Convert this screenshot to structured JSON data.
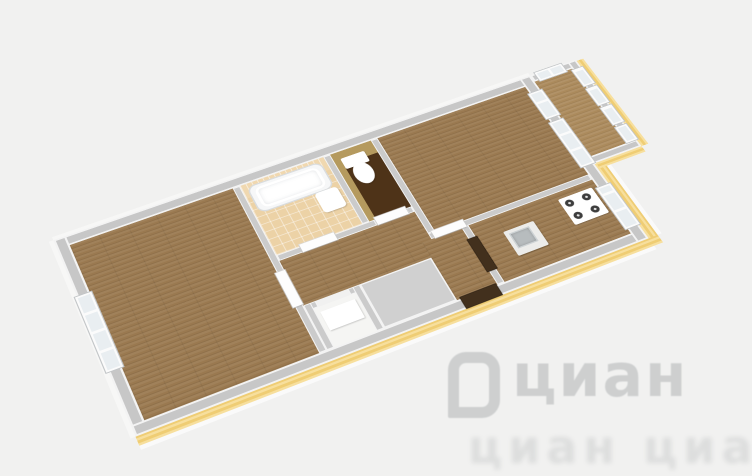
{
  "image": {
    "kind": "3d-apartment-floor-plan"
  },
  "watermark": {
    "brand_text": "циан",
    "tiled_text": "циан циан",
    "logo": "cian-logo"
  },
  "rooms": [
    {
      "name": "bedroom",
      "floor": "wood",
      "features": [
        "window-west"
      ]
    },
    {
      "name": "bathroom",
      "floor": "tile",
      "features": [
        "bathtub",
        "sink",
        "tiled-wall"
      ]
    },
    {
      "name": "wc",
      "floor": "dark-brown",
      "features": [
        "toilet",
        "khaki-walls"
      ]
    },
    {
      "name": "hallway",
      "floor": "wood",
      "features": [
        "entrance-door",
        "storage-niche"
      ]
    },
    {
      "name": "living-room",
      "floor": "wood",
      "features": [
        "balcony-door",
        "window-east"
      ]
    },
    {
      "name": "kitchen",
      "floor": "wood",
      "features": [
        "stove",
        "sink",
        "window-east"
      ]
    },
    {
      "name": "balcony",
      "floor": "wood",
      "features": [
        "glazing-4-panes",
        "window-north"
      ]
    }
  ],
  "colors": {
    "bg": "#f1f1f0",
    "wall-top": "#c7c7c7",
    "wall-edge": "#f3f3f3",
    "wood": "#9a7950",
    "wood-light": "#ab8a5c",
    "tile": "#ecd2a6",
    "tile-wall": "#f0d8b0",
    "khaki": "#b59a5e",
    "toilet-floor": "#4e3318",
    "band": "#efcd74",
    "band-light": "#f7df9d",
    "glass": "#e9eef1",
    "door-dark": "#42301d",
    "wm": "#7d8285"
  }
}
